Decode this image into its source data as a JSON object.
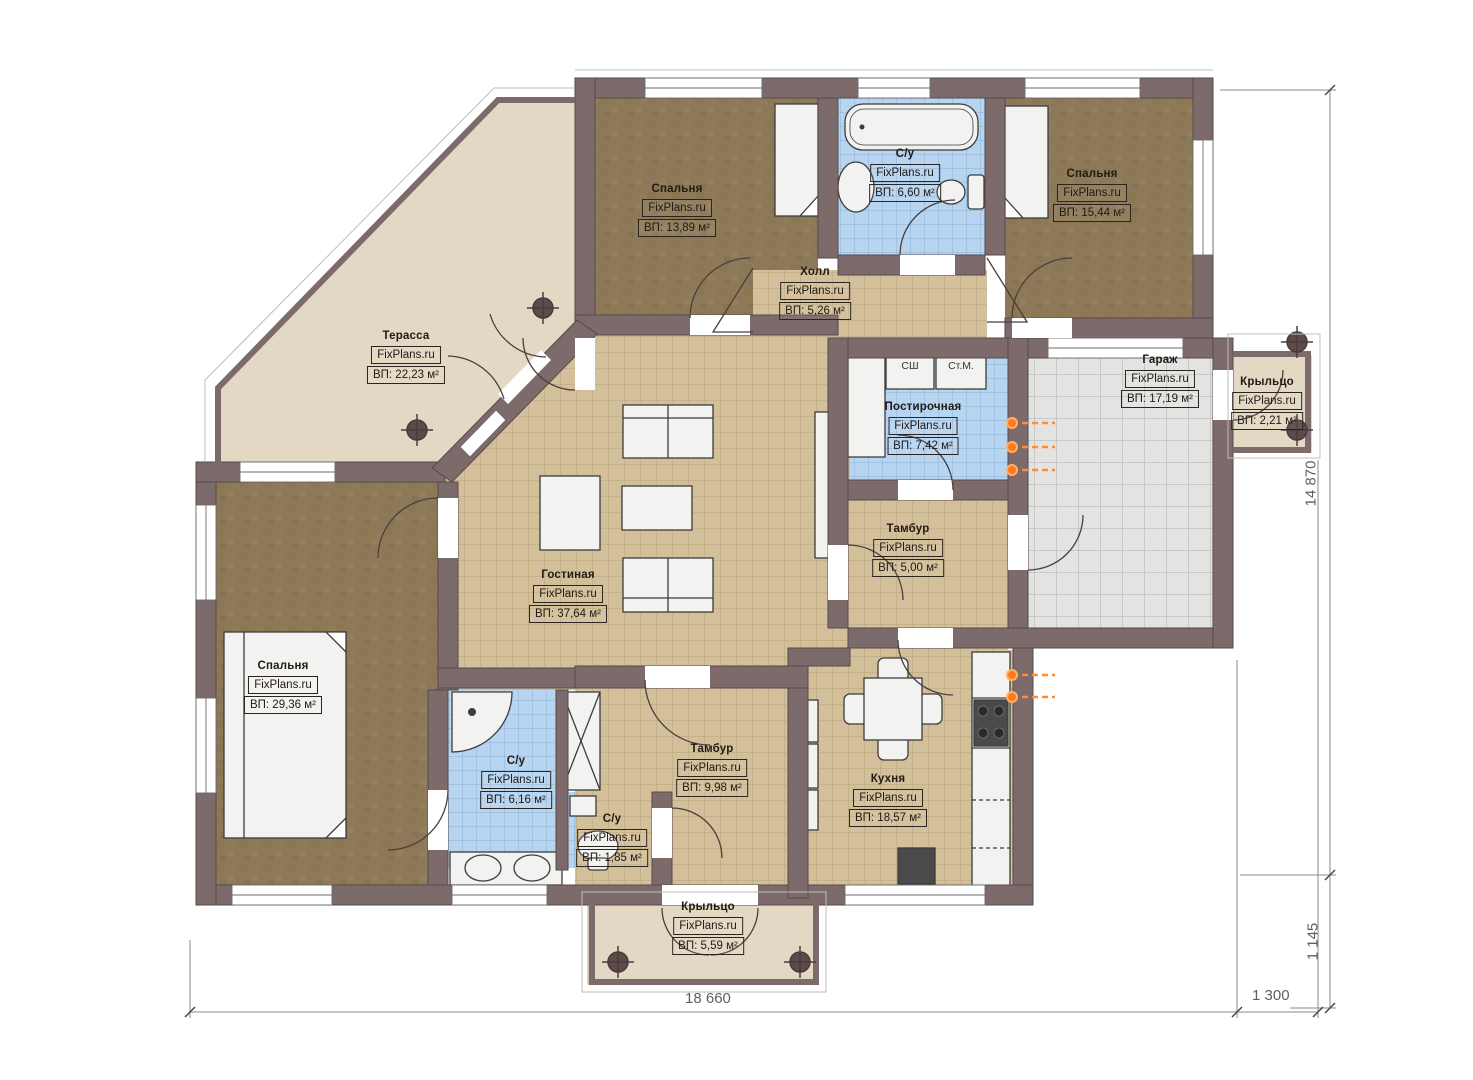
{
  "title": "План первого этажа",
  "watermark": "FixPlans.ru",
  "rooms": [
    {
      "name": "Спальня",
      "area": "ВП: 13,89 м²"
    },
    {
      "name": "С/у",
      "area": "ВП: 6,60 м²"
    },
    {
      "name": "Спальня",
      "area": "ВП: 15,44 м²"
    },
    {
      "name": "Холл",
      "area": "ВП: 5,26 м²"
    },
    {
      "name": "Терасса",
      "area": "ВП: 22,23 м²"
    },
    {
      "name": "Гараж",
      "area": "ВП: 17,19 м²"
    },
    {
      "name": "Крыльцо",
      "area": "ВП: 2,21 м²"
    },
    {
      "name": "Постирочная",
      "area": "ВП: 7,42 м²"
    },
    {
      "name": "Тамбур",
      "area": "ВП: 5,00 м²"
    },
    {
      "name": "Гостиная",
      "area": "ВП: 37,64 м²"
    },
    {
      "name": "Спальня",
      "area": "ВП: 29,36 м²"
    },
    {
      "name": "С/у",
      "area": "ВП: 6,16 м²"
    },
    {
      "name": "С/у",
      "area": "ВП: 1,85 м²"
    },
    {
      "name": "Тамбур",
      "area": "ВП: 9,98 м²"
    },
    {
      "name": "Кухня",
      "area": "ВП: 18,57 м²"
    },
    {
      "name": "Крыльцо",
      "area": "ВП: 5,59 м²"
    }
  ],
  "appliances": {
    "dryer": "СШ",
    "washer": "Ст.М."
  },
  "dimensions": {
    "bottom_main": "18 660",
    "bottom_porch": "1 300",
    "right_main": "14 870",
    "right_porch": "1 145"
  },
  "colors": {
    "wall": "#7d6a6b",
    "tile_tan": "#d3bf99",
    "tile_blue": "#b7d4f0",
    "floor_brown": "#8d7958",
    "terrace_beige": "#e2d8c3",
    "garage_gray": "#e3e3e2",
    "radiator_orange": "#ff8c33"
  }
}
